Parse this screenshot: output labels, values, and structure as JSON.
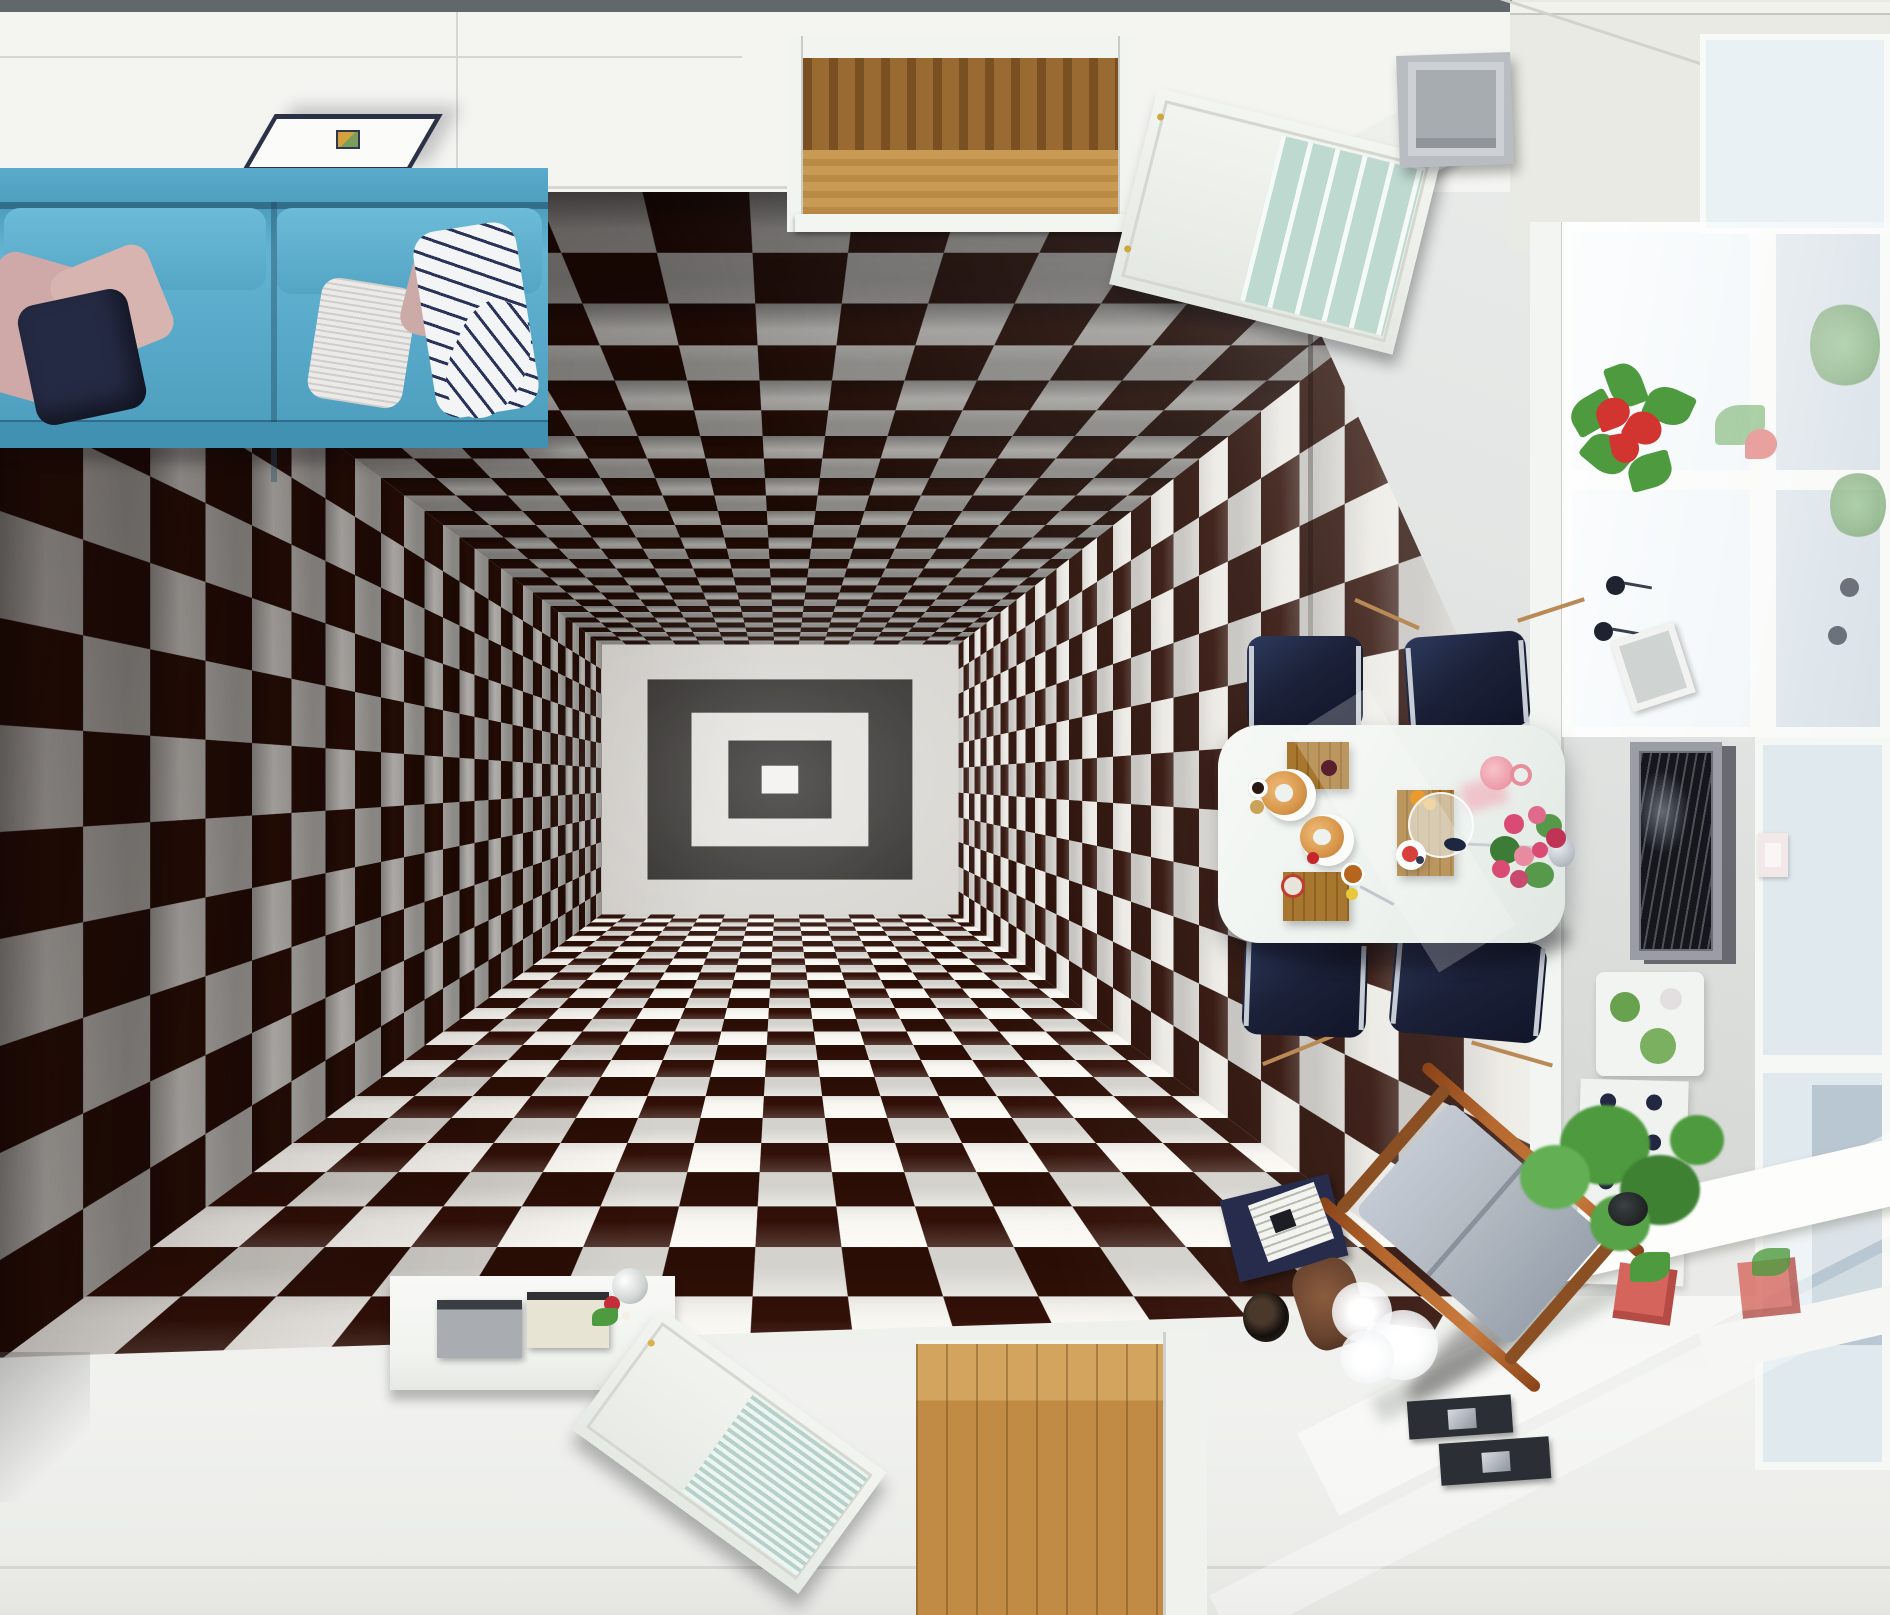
{
  "scene": {
    "description": "Top-down 3D render of a living room whose floor is a black-and-white checkerboard infinite-tunnel optical illusion mural",
    "objects": [
      "checker-tunnel-floor-mural",
      "blue-fabric-sofa",
      "pink-pillow",
      "navy-pillow",
      "knit-pillow",
      "striped-throw-blanket",
      "ceiling-panel-lamp",
      "hallway-doorway-wood-floor",
      "open-white-door",
      "gray-speaker-box",
      "dining-table",
      "navy-dining-chair",
      "wooden-serving-board",
      "croissant",
      "glass-dome",
      "pink-pitcher",
      "rose-bouquet",
      "pendant-lamp",
      "framed-artwork",
      "mini-picture-frame",
      "light-switch",
      "anthurium-plant",
      "succulent-shelf",
      "bottle-rack",
      "ivy-plant",
      "red-planter-box",
      "window",
      "window-sill",
      "sun-streaks",
      "white-sideboard",
      "flat-tv-panel",
      "glass-ball-vase",
      "lying-white-door",
      "wood-floor-patch",
      "navy-book",
      "white-paper",
      "black-vase",
      "feather-duster",
      "rocking-lounger-chair",
      "dark-coaster-frame"
    ]
  },
  "colors": {
    "checker_dark": "#2e0f07",
    "checker_light": "#e6e4df",
    "sofa": "#5aabcb",
    "pillow_pink": "#cfa9a7",
    "pillow_navy": "#252a44",
    "pillow_white": "#eceae7",
    "ceiling_white": "#f4f4f1",
    "top_band": "#62676c",
    "lamp_frame": "#2b3146",
    "wood_floor": "#c18a45",
    "door_glass": "#bdd9d0",
    "chair_navy": "#1b2138",
    "chrome": "#c6cdd5",
    "board_wood": "#a8772f",
    "croissant": "#d7964a",
    "rose_pink": "#d94b72",
    "leaf_green": "#4e9a3e",
    "anthurium_red": "#d2342f",
    "planter_red": "#d5655c",
    "pitcher_pink": "#eb9aa6",
    "window_glass": "#cdd8e0",
    "frame_silver": "#9a9ca6",
    "art_dark": "#15171d",
    "floor_white": "#f1f2ef",
    "cushion_gray": "#b3bac2",
    "chair_wood": "#b5682f",
    "duster_brown": "#6b452f",
    "book_navy": "#272c4c"
  },
  "tunnel": {
    "type": "perspective-checkerboard-shaft",
    "tile_px": 107,
    "depth_px": 3000,
    "perspective_px": 900,
    "vanishing_point": "50.5% 50.5%",
    "rings": [
      "#d8d6d1",
      "#2e2c29",
      "#e3e1dc",
      "#232120",
      "#f0efec",
      "#1a1918",
      "#e8e7e3",
      "#0c0b0a"
    ],
    "ring_insets_pct": [
      0,
      14,
      26,
      36,
      45,
      53,
      60,
      66
    ]
  }
}
